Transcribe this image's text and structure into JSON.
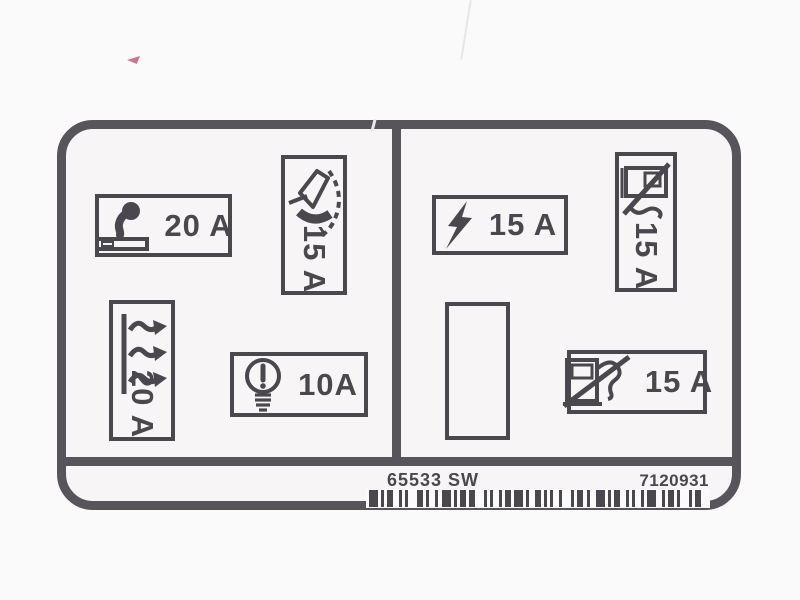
{
  "colors": {
    "ink": "#4b484d",
    "label_border": "#57545a",
    "label_background": "#f7f5f6",
    "page_background": "#fbfafa",
    "scan_mark_red": "#c2607b"
  },
  "fuse_panel": {
    "left": {
      "cigarette_lighter": {
        "icon": "cigarette-lighter-icon",
        "amperage": "20 A",
        "orientation": "horizontal"
      },
      "windshield_wiper": {
        "icon": "windshield-wiper-icon",
        "amperage": "15 A",
        "orientation": "vertical"
      },
      "heated_rear_window": {
        "icon": "heated-rear-window-icon",
        "amperage": "20 A",
        "orientation": "vertical"
      },
      "light_bulb": {
        "icon": "light-bulb-icon",
        "amperage": "10A",
        "orientation": "horizontal"
      }
    },
    "right": {
      "power": {
        "icon": "lightning-bolt-icon",
        "amperage": "15 A",
        "orientation": "horizontal"
      },
      "rear_pump_upper": {
        "icon": "fuel-pump-crossed-icon",
        "amperage": "15 A",
        "orientation": "vertical"
      },
      "spare_slot": {
        "icon": null,
        "amperage": "",
        "orientation": "vertical-empty"
      },
      "rear_pump_lower": {
        "icon": "fuel-pump-crossed-icon",
        "amperage": "15 A",
        "orientation": "horizontal"
      }
    }
  },
  "footer": {
    "part_number": "65533 SW",
    "serial_number": "7120931"
  }
}
